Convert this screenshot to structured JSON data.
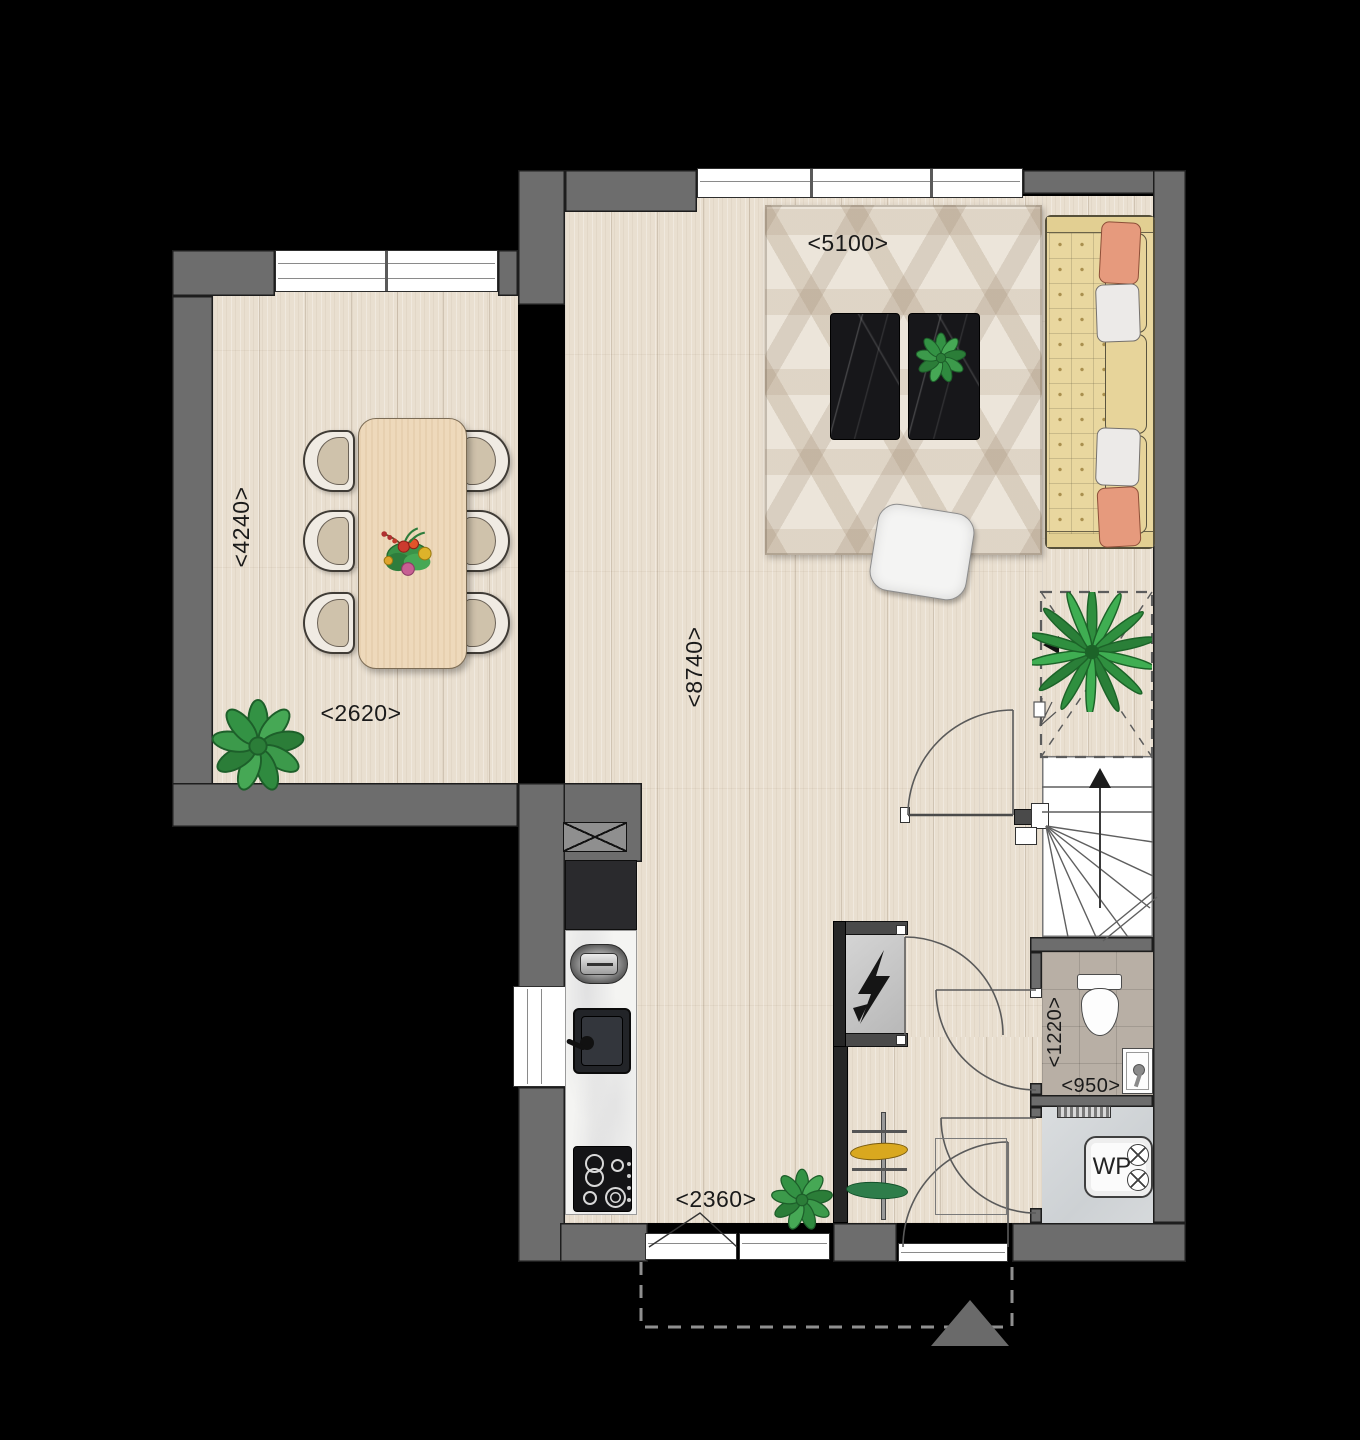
{
  "plan": {
    "dimension_labels": {
      "living_width": "<5100>",
      "dining_depth": "<4240>",
      "dining_width": "<2620>",
      "house_depth": "<8740>",
      "kitchen_width": "<2360>",
      "toilet_depth": "<1220>",
      "toilet_width": "<950>"
    },
    "equipment": {
      "heat_pump": "WP"
    },
    "colors": {
      "background": "#000000",
      "wall": "#6d6d6d",
      "wall_dark": "#262626",
      "floor_wood": "#e9dfd0",
      "rug_base": "#ece5da",
      "sofa": "#e9d79f",
      "pillow_accent": "#e69a7d",
      "counter_marble": "#f4f4f2",
      "appliance_dark": "#141416",
      "toilet_tile": "#b8afa5",
      "tech_room_floor": "#d5d8da",
      "plant_green": "#339244",
      "entrance_marker": "#6a6a6a"
    }
  }
}
